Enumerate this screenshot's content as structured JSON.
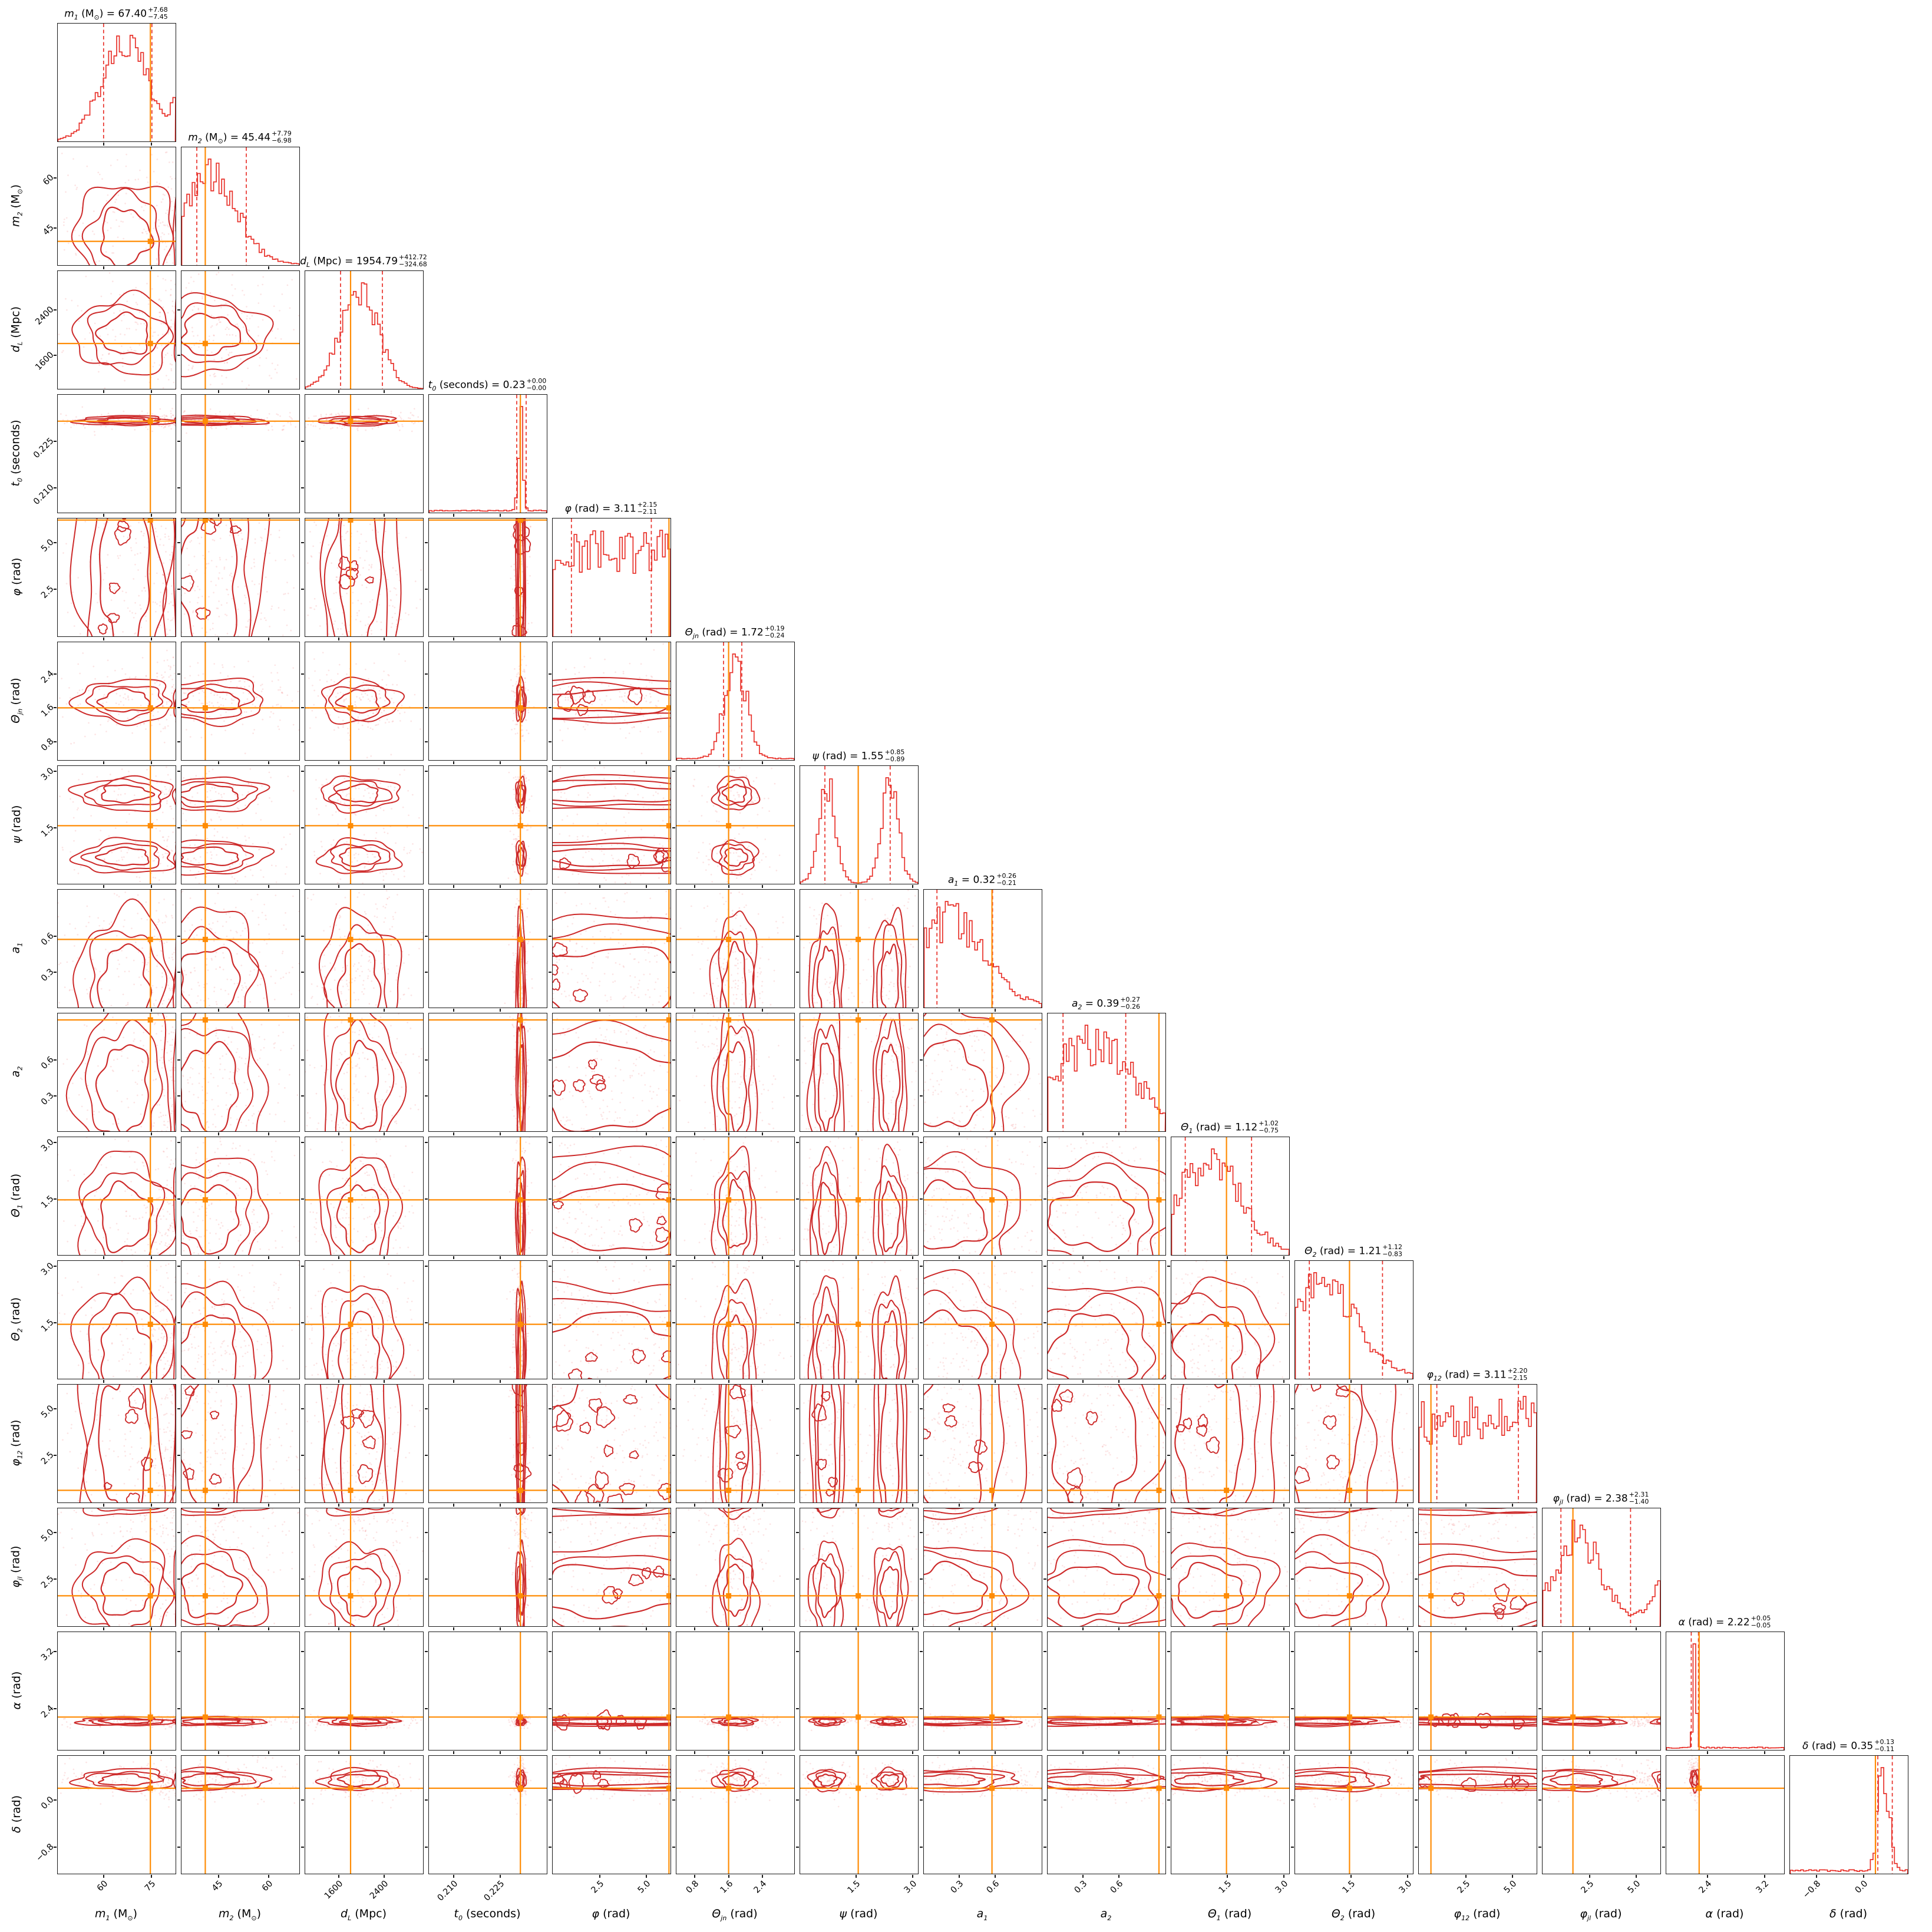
{
  "figure": {
    "kind": "corner plot (posterior triangle plot) of 15 compact-binary parameters",
    "n_parameters": 15,
    "legend": "red step histograms on the diagonal with dashed 16%/84% quantile lines; red 2-D contours with pink scatter off-diagonal; orange solid lines/squares mark reference values"
  },
  "style": {
    "background": "#ffffff",
    "frame_color": "#1a1a1a",
    "hist_color": "#e8312a",
    "contour_color": "#cd2a2a",
    "scatter_color": "rgba(240,122,122,0.20)",
    "quantile_dash_color": "#e8312a",
    "truth_color": "#ff8c05",
    "text_color": "#000000"
  },
  "chart_data": {
    "type": "corner",
    "layout_note": "15x15 lower-triangular grid; diagonal = 1-D marginal histograms; (i,j) = joint of column parameter (x) vs row parameter (y)",
    "parameters": [
      {
        "id": "m1",
        "symbol": "m",
        "subscript": "1",
        "unit": {
          "pre": "(M",
          "sub": "⊙",
          "post": ")"
        },
        "axis_label": "m1 (M⊙)",
        "title_text": "m1 (M⊙) = 67.40 +7.68 −7.45",
        "estimate": {
          "median": "67.40",
          "plus": "+7.68",
          "minus": "−7.45"
        },
        "range": [
          45.6,
          82.5
        ],
        "ticks": [
          {
            "value": 60,
            "label": "60",
            "f": 0.39
          },
          {
            "value": 75,
            "label": "75",
            "f": 0.797
          }
        ],
        "truth": {
          "value": 74.6,
          "f": 0.786
        },
        "quantiles": {
          "q16_f": 0.389,
          "q84_f": 0.799
        },
        "dist": {
          "kind": "hump",
          "modes": [
            {
              "f": 0.57,
              "s": 0.2,
              "w": 1
            },
            {
              "f": 1.06,
              "s": 0.08,
              "w": 0.45
            }
          ],
          "floor": 0.0,
          "noise": 0.35
        }
      },
      {
        "id": "m2",
        "symbol": "m",
        "subscript": "2",
        "unit": {
          "pre": "(M",
          "sub": "⊙",
          "post": ")"
        },
        "axis_label": "m2 (M⊙)",
        "title_text": "m2 (M⊙) = 45.44 +7.79 −6.98",
        "estimate": {
          "median": "45.44",
          "plus": "+7.79",
          "minus": "−6.98"
        },
        "range": [
          33.9,
          69.1
        ],
        "ticks": [
          {
            "value": 45,
            "label": "45",
            "f": 0.316
          },
          {
            "value": 60,
            "label": "60",
            "f": 0.742
          }
        ],
        "truth": {
          "value": 41.0,
          "f": 0.202
        },
        "quantiles": {
          "q16_f": 0.13,
          "q84_f": 0.55
        },
        "dist": {
          "kind": "hump",
          "modes": [
            {
              "f": 0.24,
              "s": 0.23,
              "w": 1
            }
          ],
          "floor": 0.01,
          "noise": 0.4
        }
      },
      {
        "id": "dL",
        "symbol": "d",
        "subscript": "L",
        "unit": {
          "pre": "(Mpc)",
          "sub": "",
          "post": ""
        },
        "axis_label": "dL (Mpc)",
        "title_text": "dL (Mpc) = 1954.79 +412.72 −324.68",
        "estimate": {
          "median": "1954.79",
          "plus": "+412.72",
          "minus": "−324.68"
        },
        "range": [
          1007,
          3083
        ],
        "ticks": [
          {
            "value": 1600,
            "label": "1600",
            "f": 0.286
          },
          {
            "value": 2400,
            "label": "2400",
            "f": 0.671
          }
        ],
        "truth": {
          "value": 1806,
          "f": 0.385
        },
        "quantiles": {
          "q16_f": 0.3,
          "q84_f": 0.655
        },
        "dist": {
          "kind": "hump",
          "modes": [
            {
              "f": 0.46,
              "s": 0.16,
              "w": 1
            }
          ],
          "floor": 0.0,
          "noise": 0.3
        }
      },
      {
        "id": "t0",
        "symbol": "t",
        "subscript": "0",
        "unit": {
          "pre": "(seconds)",
          "sub": "",
          "post": ""
        },
        "axis_label": "t0 (seconds)",
        "title_text": "t0 (seconds) = 0.23 +0.00 −0.00",
        "estimate": {
          "median": "0.23",
          "plus": "+0.00",
          "minus": "−0.00"
        },
        "range": [
          0.202,
          0.24
        ],
        "ticks": [
          {
            "value": 0.21,
            "label": "0.210",
            "f": 0.211
          },
          {
            "value": 0.225,
            "label": "0.225",
            "f": 0.605
          }
        ],
        "truth": {
          "value": 0.2315,
          "f": 0.776
        },
        "quantiles": {
          "q16_f": 0.745,
          "q84_f": 0.825
        },
        "dist": {
          "kind": "narrow",
          "modes": [
            {
              "f": 0.78,
              "s": 0.02,
              "w": 1
            }
          ],
          "floor": 0.02,
          "noise": 0.5
        }
      },
      {
        "id": "phi",
        "symbol": "φ",
        "subscript": "",
        "unit": {
          "pre": "(rad)",
          "sub": "",
          "post": ""
        },
        "axis_label": "φ (rad)",
        "title_text": "φ (rad) = 3.11 +2.15 −2.11",
        "estimate": {
          "median": "3.11",
          "plus": "+2.15",
          "minus": "−2.11"
        },
        "range": [
          0,
          6.283
        ],
        "ticks": [
          {
            "value": 2.5,
            "label": "2.5",
            "f": 0.398
          },
          {
            "value": 5.0,
            "label": "5.0",
            "f": 0.796
          }
        ],
        "truth": {
          "value": 6.2,
          "f": 0.987
        },
        "quantiles": {
          "q16_f": 0.159,
          "q84_f": 0.837
        },
        "dist": {
          "kind": "uniform",
          "modes": [],
          "floor": 0.0,
          "noise": 0.5
        }
      },
      {
        "id": "theta_jn",
        "symbol": "Θ",
        "subscript": "jn",
        "unit": {
          "pre": "(rad)",
          "sub": "",
          "post": ""
        },
        "axis_label": "Θjn (rad)",
        "title_text": "Θjn (rad) = 1.72 +0.19 −0.24",
        "estimate": {
          "median": "1.72",
          "plus": "+0.19",
          "minus": "−0.24"
        },
        "range": [
          0.37,
          3.144
        ],
        "ticks": [
          {
            "value": 0.8,
            "label": "0.8",
            "f": 0.155
          },
          {
            "value": 1.6,
            "label": "1.6",
            "f": 0.443
          },
          {
            "value": 2.4,
            "label": "2.4",
            "f": 0.732
          }
        ],
        "truth": {
          "value": 1.6,
          "f": 0.443
        },
        "quantiles": {
          "q16_f": 0.4,
          "q84_f": 0.555
        },
        "dist": {
          "kind": "hump",
          "modes": [
            {
              "f": 0.5,
              "s": 0.09,
              "w": 1
            }
          ],
          "floor": 0.015,
          "noise": 0.45
        }
      },
      {
        "id": "psi",
        "symbol": "ψ",
        "subscript": "",
        "unit": {
          "pre": "(rad)",
          "sub": "",
          "post": ""
        },
        "axis_label": "ψ (rad)",
        "title_text": "ψ (rad) = 1.55 +0.85 −0.89",
        "estimate": {
          "median": "1.55",
          "plus": "+0.85",
          "minus": "−0.89"
        },
        "range": [
          0,
          3.1416
        ],
        "ticks": [
          {
            "value": 1.5,
            "label": "1.5",
            "f": 0.477
          },
          {
            "value": 3.0,
            "label": "3.0",
            "f": 0.955
          }
        ],
        "truth": {
          "value": 1.55,
          "f": 0.493
        },
        "quantiles": {
          "q16_f": 0.21,
          "q84_f": 0.764
        },
        "dist": {
          "kind": "bimodal",
          "modes": [
            {
              "f": 0.228,
              "s": 0.07,
              "w": 1
            },
            {
              "f": 0.764,
              "s": 0.07,
              "w": 0.98
            }
          ],
          "floor": 0.01,
          "noise": 0.4
        }
      },
      {
        "id": "a1",
        "symbol": "a",
        "subscript": "1",
        "unit": {
          "pre": "",
          "sub": "",
          "post": ""
        },
        "axis_label": "a1",
        "title_text": "a1 = 0.32 +0.26 −0.21",
        "estimate": {
          "median": "0.32",
          "plus": "+0.26",
          "minus": "−0.21"
        },
        "range": [
          0,
          0.995
        ],
        "ticks": [
          {
            "value": 0.3,
            "label": "0.3",
            "f": 0.302
          },
          {
            "value": 0.6,
            "label": "0.6",
            "f": 0.603
          }
        ],
        "truth": {
          "value": 0.575,
          "f": 0.578
        },
        "quantiles": {
          "q16_f": 0.111,
          "q84_f": 0.583
        },
        "dist": {
          "kind": "hump",
          "modes": [
            {
              "f": 0.2,
              "s": 0.3,
              "w": 1
            }
          ],
          "floor": 0.02,
          "noise": 0.45
        }
      },
      {
        "id": "a2",
        "symbol": "a",
        "subscript": "2",
        "unit": {
          "pre": "",
          "sub": "",
          "post": ""
        },
        "axis_label": "a2",
        "title_text": "a2 = 0.39 +0.27 −0.26",
        "estimate": {
          "median": "0.39",
          "plus": "+0.27",
          "minus": "−0.26"
        },
        "range": [
          0,
          0.995
        ],
        "ticks": [
          {
            "value": 0.3,
            "label": "0.3",
            "f": 0.302
          },
          {
            "value": 0.6,
            "label": "0.6",
            "f": 0.603
          }
        ],
        "truth": {
          "value": 0.94,
          "f": 0.945
        },
        "quantiles": {
          "q16_f": 0.131,
          "q84_f": 0.663
        },
        "dist": {
          "kind": "hump",
          "modes": [
            {
              "f": 0.38,
              "s": 0.34,
              "w": 1
            }
          ],
          "floor": 0.03,
          "noise": 0.5
        }
      },
      {
        "id": "theta1",
        "symbol": "Θ",
        "subscript": "1",
        "unit": {
          "pre": "(rad)",
          "sub": "",
          "post": ""
        },
        "axis_label": "Θ1 (rad)",
        "title_text": "Θ1 (rad) = 1.12 +1.02 −0.75",
        "estimate": {
          "median": "1.12",
          "plus": "+1.02",
          "minus": "−0.75"
        },
        "range": [
          0,
          3.1416
        ],
        "ticks": [
          {
            "value": 1.5,
            "label": "1.5",
            "f": 0.477
          },
          {
            "value": 3.0,
            "label": "3.0",
            "f": 0.955
          }
        ],
        "truth": {
          "value": 1.47,
          "f": 0.468
        },
        "quantiles": {
          "q16_f": 0.118,
          "q84_f": 0.681
        },
        "dist": {
          "kind": "hump",
          "modes": [
            {
              "f": 0.32,
              "s": 0.26,
              "w": 1
            }
          ],
          "floor": 0.02,
          "noise": 0.45
        }
      },
      {
        "id": "theta2",
        "symbol": "Θ",
        "subscript": "2",
        "unit": {
          "pre": "(rad)",
          "sub": "",
          "post": ""
        },
        "axis_label": "Θ2 (rad)",
        "title_text": "Θ2 (rad) = 1.21 +1.12 −0.83",
        "estimate": {
          "median": "1.21",
          "plus": "+1.12",
          "minus": "−0.83"
        },
        "range": [
          0,
          3.1416
        ],
        "ticks": [
          {
            "value": 1.5,
            "label": "1.5",
            "f": 0.477
          },
          {
            "value": 3.0,
            "label": "3.0",
            "f": 0.955
          }
        ],
        "truth": {
          "value": 1.45,
          "f": 0.462
        },
        "quantiles": {
          "q16_f": 0.121,
          "q84_f": 0.742
        },
        "dist": {
          "kind": "hump",
          "modes": [
            {
              "f": 0.22,
              "s": 0.3,
              "w": 1
            }
          ],
          "floor": 0.02,
          "noise": 0.45
        }
      },
      {
        "id": "phi12",
        "symbol": "φ",
        "subscript": "12",
        "unit": {
          "pre": "(rad)",
          "sub": "",
          "post": ""
        },
        "axis_label": "φ12 (rad)",
        "title_text": "φ12 (rad) = 3.11 +2.20 −2.15",
        "estimate": {
          "median": "3.11",
          "plus": "+2.20",
          "minus": "−2.15"
        },
        "range": [
          0,
          6.283
        ],
        "ticks": [
          {
            "value": 2.5,
            "label": "2.5",
            "f": 0.398
          },
          {
            "value": 5.0,
            "label": "5.0",
            "f": 0.796
          }
        ],
        "truth": {
          "value": 0.65,
          "f": 0.103
        },
        "quantiles": {
          "q16_f": 0.153,
          "q84_f": 0.845
        },
        "dist": {
          "kind": "uniform",
          "modes": [],
          "floor": 0.0,
          "noise": 0.55
        }
      },
      {
        "id": "phi_jl",
        "symbol": "φ",
        "subscript": "jl",
        "unit": {
          "pre": "(rad)",
          "sub": "",
          "post": ""
        },
        "axis_label": "φjl (rad)",
        "title_text": "φjl (rad) = 2.38 +2.31 −1.40",
        "estimate": {
          "median": "2.38",
          "plus": "+2.31",
          "minus": "−1.40"
        },
        "range": [
          0,
          6.283
        ],
        "ticks": [
          {
            "value": 2.5,
            "label": "2.5",
            "f": 0.398
          },
          {
            "value": 5.0,
            "label": "5.0",
            "f": 0.796
          }
        ],
        "truth": {
          "value": 1.62,
          "f": 0.258
        },
        "quantiles": {
          "q16_f": 0.156,
          "q84_f": 0.747
        },
        "dist": {
          "kind": "hump",
          "modes": [
            {
              "f": 0.3,
              "s": 0.2,
              "w": 1
            },
            {
              "f": 1.08,
              "s": 0.14,
              "w": 0.5
            }
          ],
          "floor": 0.03,
          "noise": 0.4
        }
      },
      {
        "id": "alpha",
        "symbol": "α",
        "subscript": "",
        "unit": {
          "pre": "(rad)",
          "sub": "",
          "post": ""
        },
        "axis_label": "α (rad)",
        "title_text": "α (rad) = 2.22 +0.05 −0.05",
        "estimate": {
          "median": "2.22",
          "plus": "+0.05",
          "minus": "−0.05"
        },
        "range": [
          1.82,
          3.47
        ],
        "ticks": [
          {
            "value": 2.4,
            "label": "2.4",
            "f": 0.352
          },
          {
            "value": 3.2,
            "label": "3.2",
            "f": 0.836
          }
        ],
        "truth": {
          "value": 2.28,
          "f": 0.279
        },
        "quantiles": {
          "q16_f": 0.212,
          "q84_f": 0.273
        },
        "dist": {
          "kind": "narrow",
          "modes": [
            {
              "f": 0.242,
              "s": 0.014,
              "w": 1
            }
          ],
          "floor": 0.025,
          "noise": 0.5
        }
      },
      {
        "id": "delta",
        "symbol": "δ",
        "subscript": "",
        "unit": {
          "pre": "(rad)",
          "sub": "",
          "post": ""
        },
        "axis_label": "δ (rad)",
        "title_text": "δ (rad) = 0.35 +0.13 −0.11",
        "estimate": {
          "median": "0.35",
          "plus": "+0.13",
          "minus": "−0.11"
        },
        "range": [
          -1.25,
          0.75
        ],
        "ticks": [
          {
            "value": -0.8,
            "label": "−0.8",
            "f": 0.225
          },
          {
            "value": 0.0,
            "label": "0.0",
            "f": 0.625
          }
        ],
        "truth": {
          "value": 0.2,
          "f": 0.725
        },
        "quantiles": {
          "q16_f": 0.745,
          "q84_f": 0.868
        },
        "dist": {
          "kind": "narrow",
          "modes": [
            {
              "f": 0.795,
              "s": 0.045,
              "w": 1
            }
          ],
          "floor": 0.03,
          "noise": 0.5
        }
      }
    ]
  }
}
